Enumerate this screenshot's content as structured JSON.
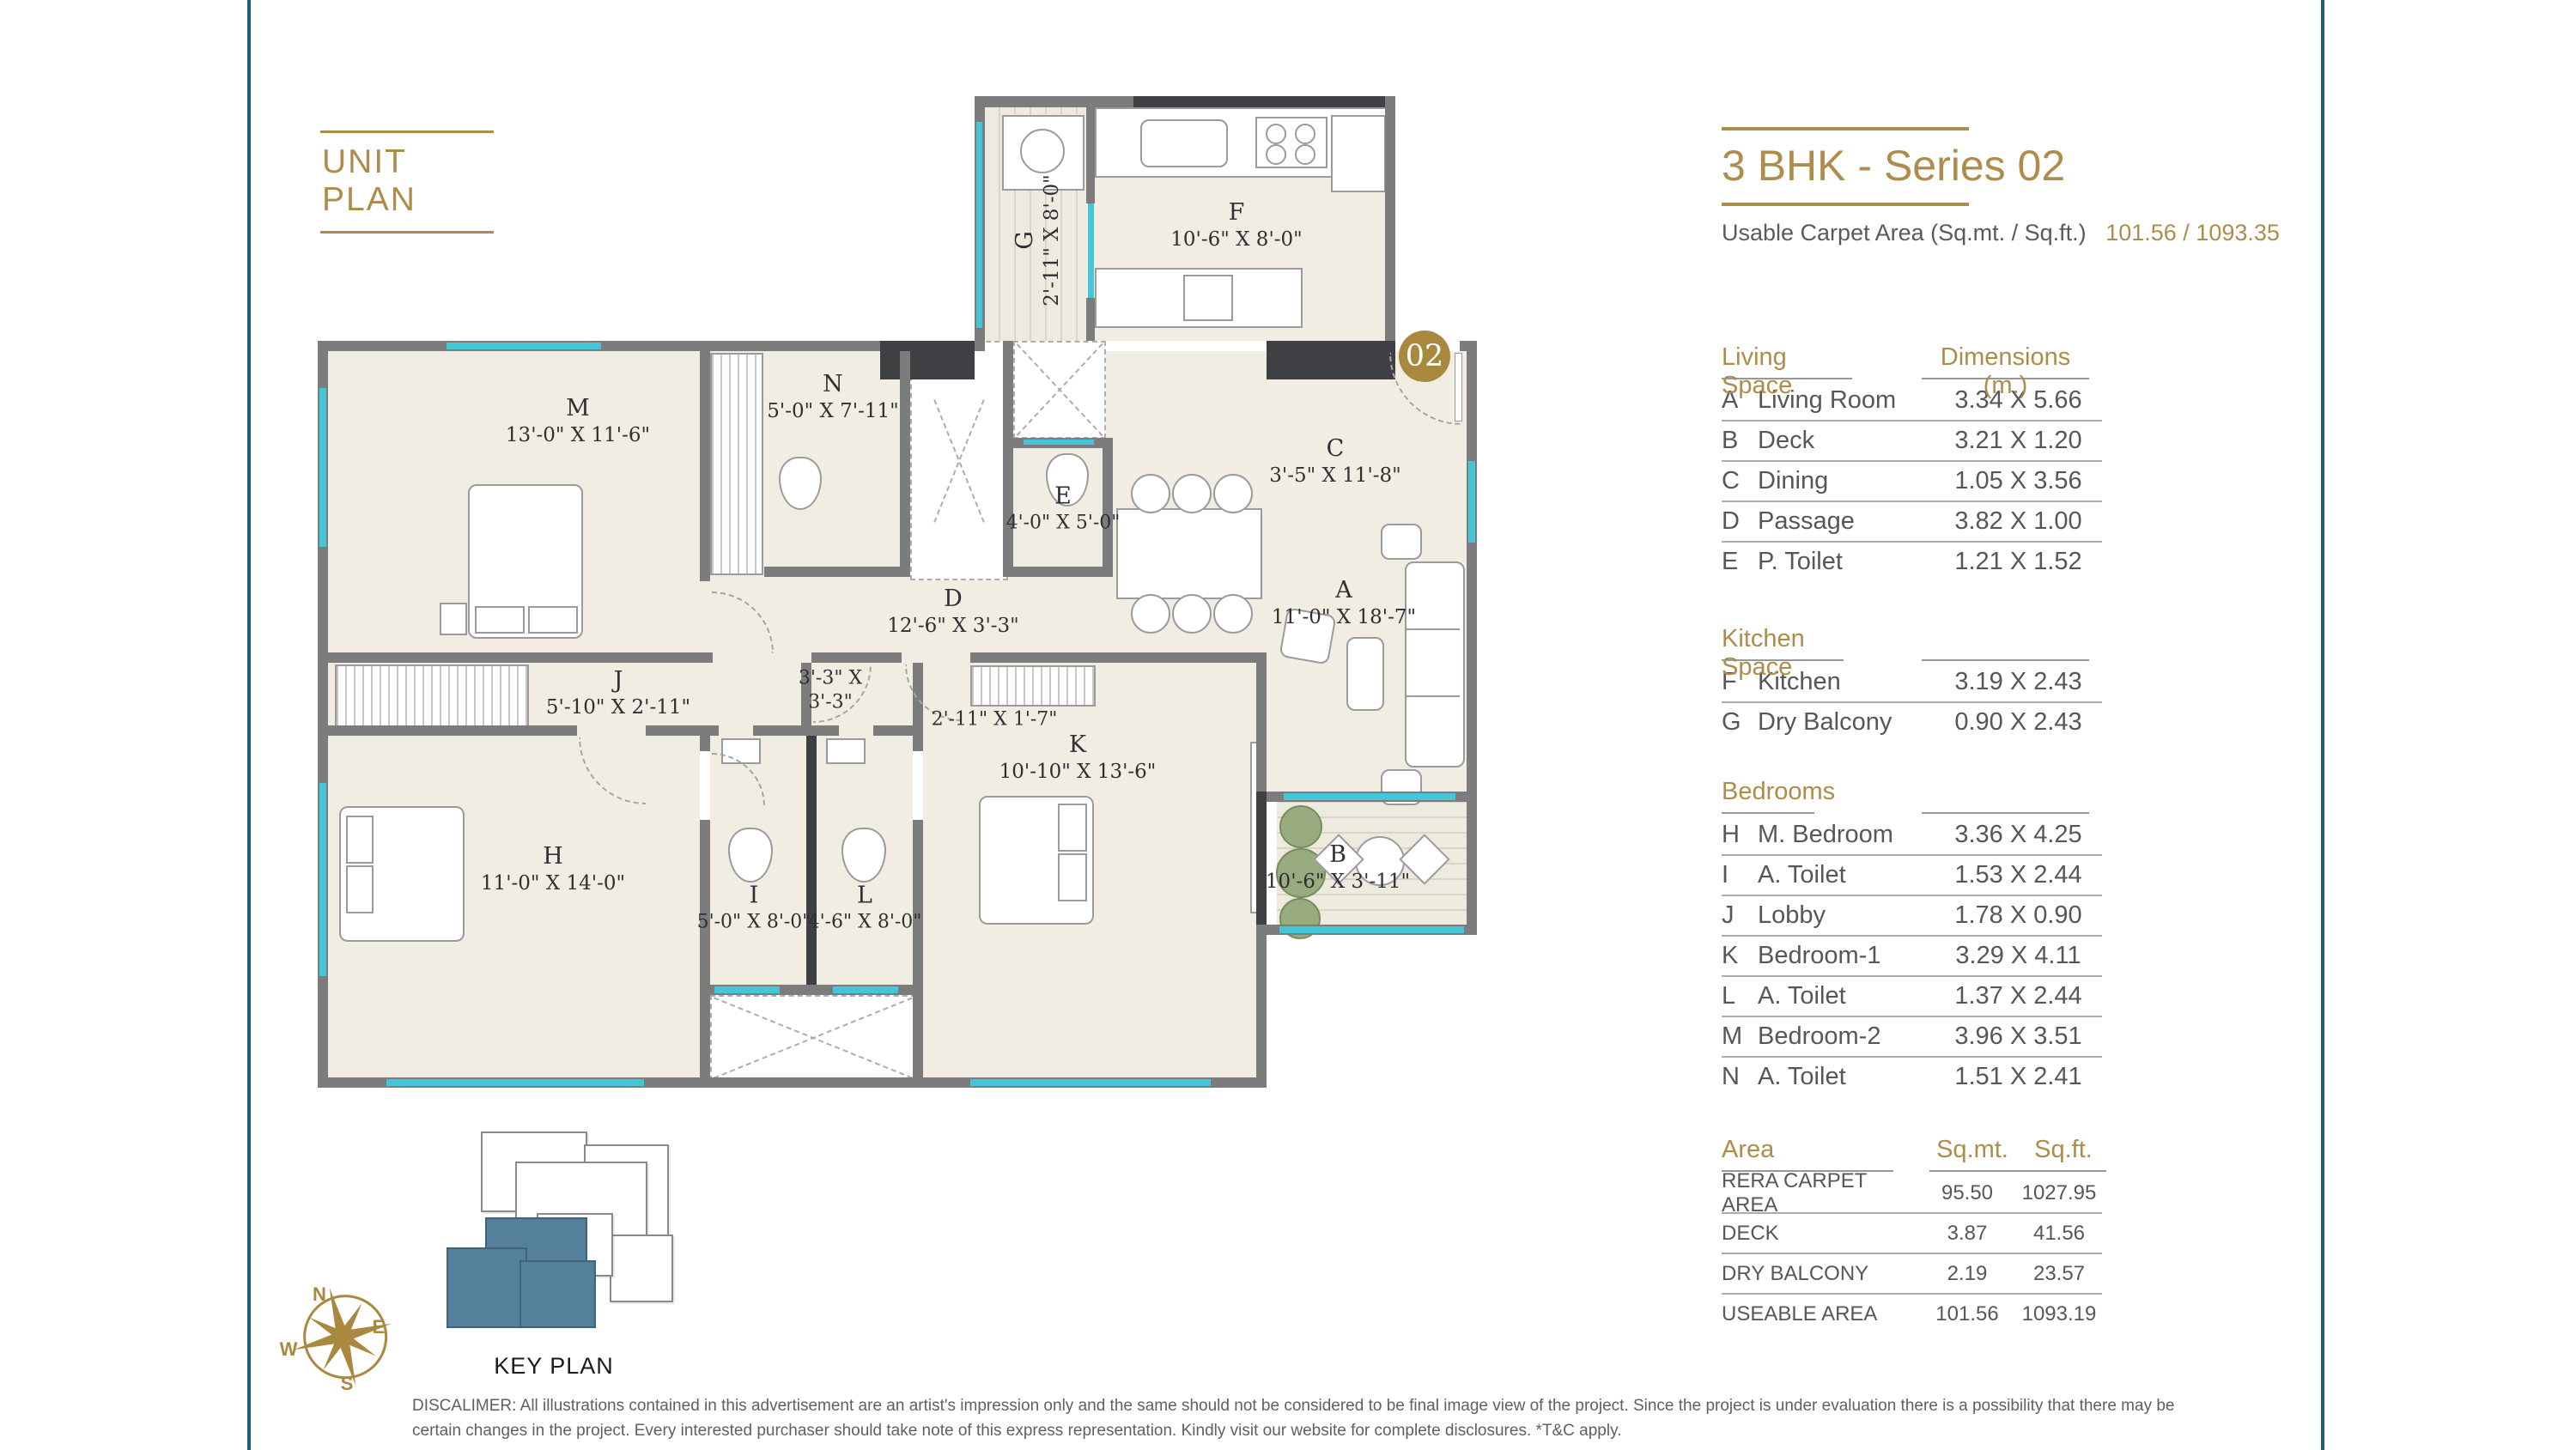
{
  "unit_plan_title": "UNIT PLAN",
  "header": {
    "title": "3 BHK - Series 02",
    "carpet_label": "Usable Carpet Area (Sq.mt. / Sq.ft.)",
    "carpet_value": "101.56 / 1093.35"
  },
  "colors": {
    "accent_gold": "#AE8C4B",
    "frame_teal": "#1A5F7C",
    "wall_gray": "#7C7C7C",
    "wall_dark": "#3F4043",
    "floor_beige": "#F1EDE2",
    "window_cyan": "#45C6D8",
    "keyplan_unit_teal": "#54809B",
    "badge_gold": "#A8893E"
  },
  "tables": {
    "living": {
      "title": "Living Space",
      "dims_header": "Dimensions (m.)",
      "rows": [
        [
          "A",
          "Living Room",
          "3.34 X 5.66"
        ],
        [
          "B",
          "Deck",
          "3.21 X 1.20"
        ],
        [
          "C",
          "Dining",
          "1.05 X 3.56"
        ],
        [
          "D",
          "Passage",
          "3.82 X 1.00"
        ],
        [
          "E",
          "P. Toilet",
          "1.21 X 1.52"
        ]
      ]
    },
    "kitchen": {
      "title": "Kitchen Space",
      "rows": [
        [
          "F",
          "Kitchen",
          "3.19 X 2.43"
        ],
        [
          "G",
          "Dry Balcony",
          "0.90 X 2.43"
        ]
      ]
    },
    "bedrooms": {
      "title": "Bedrooms",
      "rows": [
        [
          "H",
          "M. Bedroom",
          "3.36 X 4.25"
        ],
        [
          "I",
          "A. Toilet",
          "1.53 X 2.44"
        ],
        [
          "J",
          "Lobby",
          "1.78 X 0.90"
        ],
        [
          "K",
          "Bedroom-1",
          "3.29 X 4.11"
        ],
        [
          "L",
          "A. Toilet",
          "1.37 X 2.44"
        ],
        [
          "M",
          "Bedroom-2",
          "3.96 X 3.51"
        ],
        [
          "N",
          "A. Toilet",
          "1.51 X 2.41"
        ]
      ]
    },
    "area": {
      "title": "Area",
      "col1": "Sq.mt.",
      "col2": "Sq.ft.",
      "rows": [
        [
          "RERA CARPET AREA",
          "95.50",
          "1027.95"
        ],
        [
          "DECK",
          "3.87",
          "41.56"
        ],
        [
          "DRY BALCONY",
          "2.19",
          "23.57"
        ],
        [
          "USEABLE AREA",
          "101.56",
          "1093.19"
        ]
      ]
    }
  },
  "plan": {
    "badge": "02",
    "rooms": [
      {
        "letter": "A",
        "dim": "11'-0\" X 18'-7\""
      },
      {
        "letter": "B",
        "dim": "10'-6\" X 3'-11\""
      },
      {
        "letter": "C",
        "dim": "3'-5\" X 11'-8\""
      },
      {
        "letter": "D",
        "dim": "12'-6\" X 3'-3\""
      },
      {
        "letter": "E",
        "dim": "4'-0\" X 5'-0\""
      },
      {
        "letter": "F",
        "dim": "10'-6\" X 8'-0\""
      },
      {
        "letter": "G",
        "dim": "2'-11\" X 8'-0\""
      },
      {
        "letter": "H",
        "dim": "11'-0\" X 14'-0\""
      },
      {
        "letter": "I",
        "dim": "5'-0\" X 8'-0\""
      },
      {
        "letter": "J",
        "dim": "5'-10\" X 2'-11\""
      },
      {
        "letter": "K",
        "dim": "10'-10\" X 13'-6\""
      },
      {
        "letter": "L",
        "dim": "4'-6\" X 8'-0\""
      },
      {
        "letter": "M",
        "dim": "13'-0\" X 11'-6\""
      },
      {
        "letter": "N",
        "dim": "5'-0\" X 7'-11\""
      }
    ],
    "small_labels": [
      "3'-3\" X 3'-3\"",
      "2'-11\" X 1'-7\""
    ]
  },
  "key_plan": {
    "label": "KEY PLAN",
    "compass": {
      "n": "N",
      "e": "E",
      "s": "S",
      "w": "W"
    }
  },
  "disclaimer": "DISCALIMER: All illustrations contained in this advertisement are an artist's impression only and the same should not be considered to be final image view of the project. Since the project is under evaluation there is a possibility that there may be certain changes in the project. Every interested purchaser should take note of this express representation. Kindly visit our website for complete disclosures. *T&C apply."
}
